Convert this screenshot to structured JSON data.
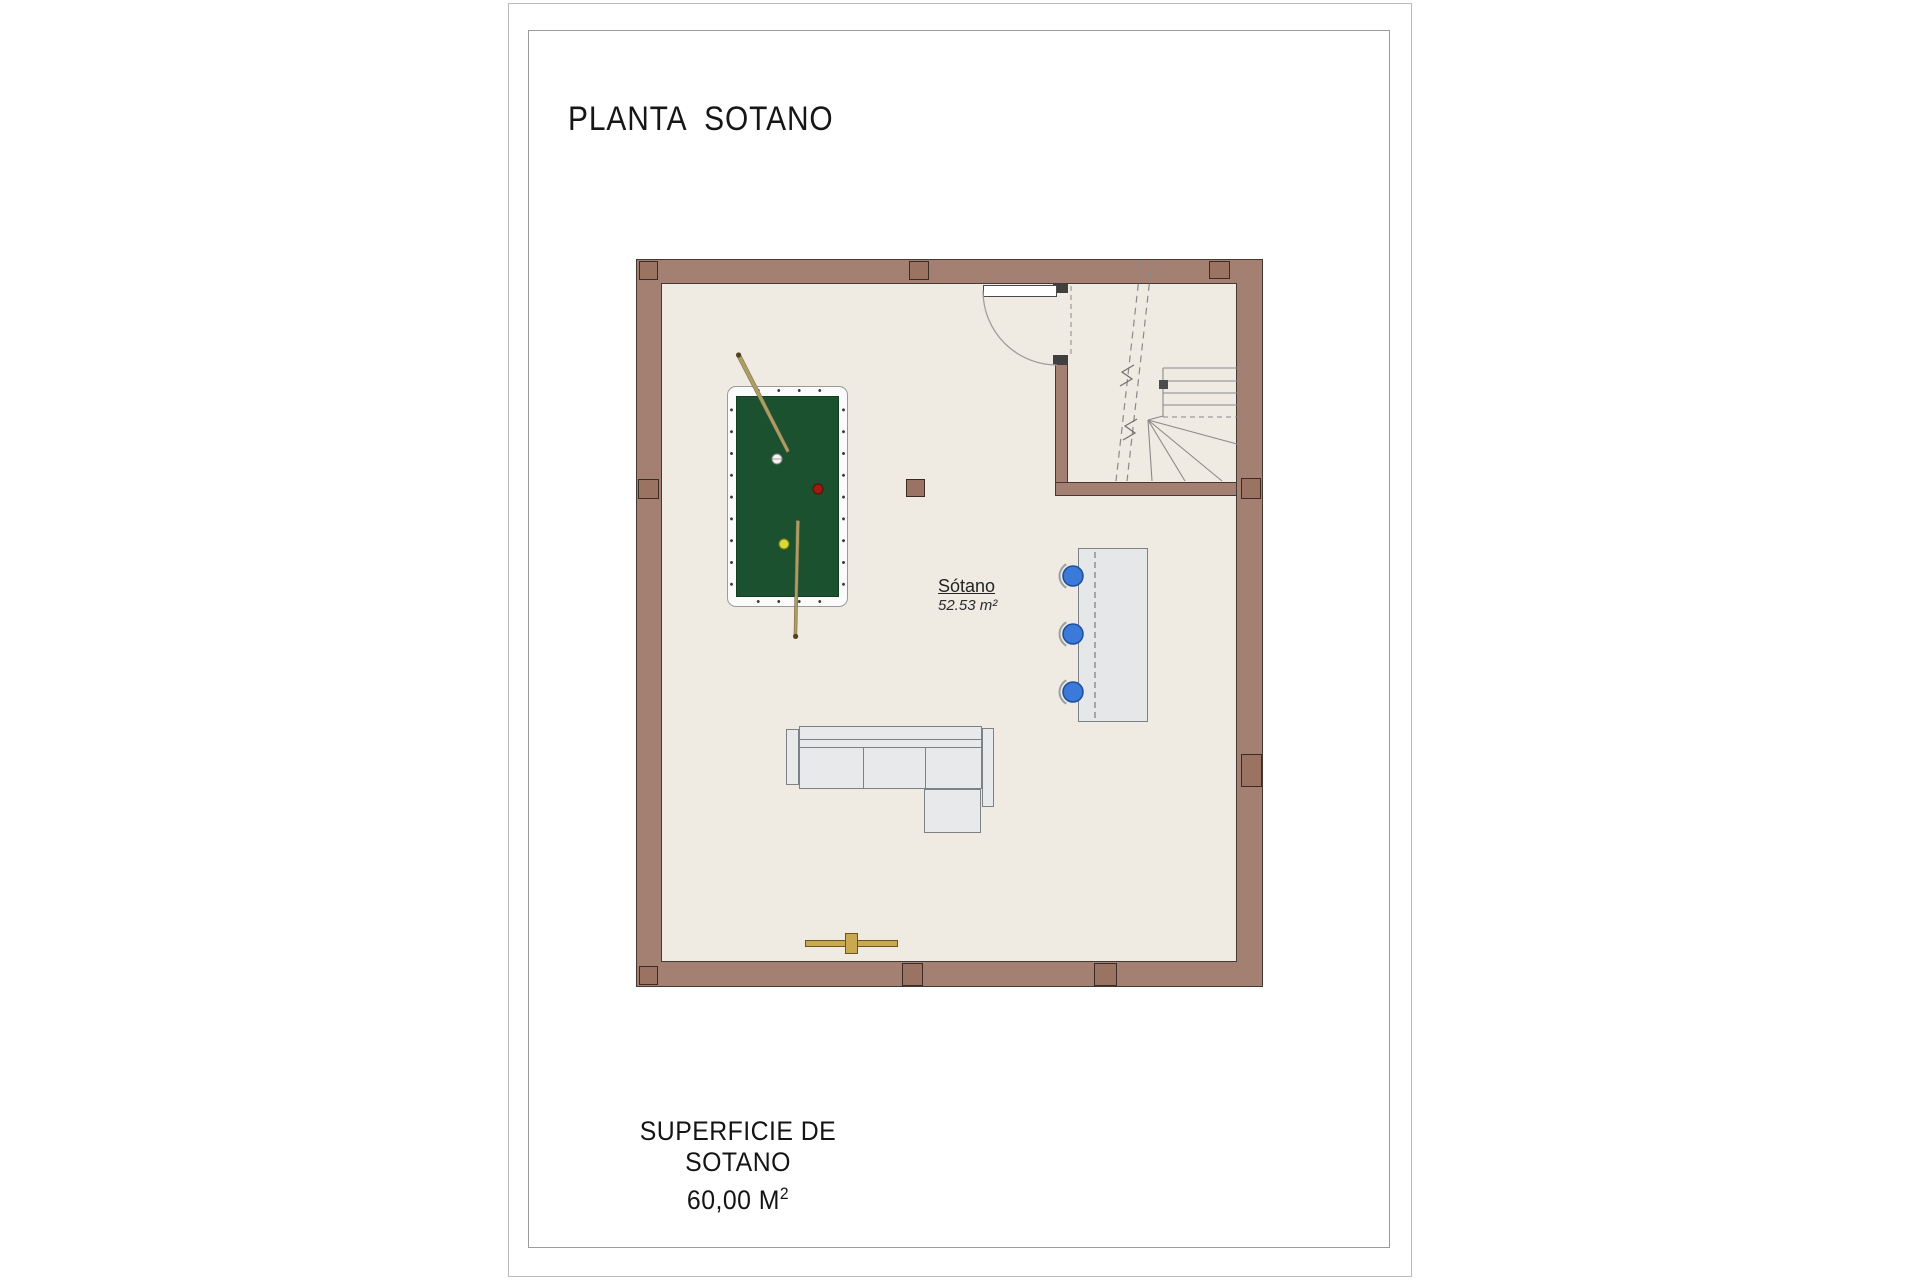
{
  "page": {
    "title": "PLANTA  SOTANO",
    "footer": {
      "line1": "SUPERFICIE DE SOTANO",
      "value": "60,00 M",
      "sup": "2"
    }
  },
  "plan": {
    "room_label": {
      "name": "Sótano",
      "area": "52.53 m²"
    }
  },
  "colors": {
    "wall": "#A38071",
    "wall_line": "#463931",
    "pier": "#9B7363",
    "pier_line": "#3A2B24",
    "floor": "#EFEAE2",
    "felt": "#1C5130",
    "felt_line": "#143D24",
    "table_frame": "#FBFBFB",
    "frame_line": "#9A9A9A",
    "sofa": "#E7E9EA",
    "furniture_line": "#7C8185",
    "counter": "#E5E7E8",
    "stool_blue": "#3B7AD9",
    "stool_line": "#1C4F9E",
    "cue": "#AC9D64",
    "cue_dark": "#54431F",
    "rack_gold": "#C9A94F",
    "rack_line": "#6B5520",
    "ball_white": "#F4F4F4",
    "ball_red": "#9E1B10",
    "ball_yellow": "#D6D93A",
    "plan_line": "#8A8A8A",
    "text": "#1E1E1E"
  }
}
